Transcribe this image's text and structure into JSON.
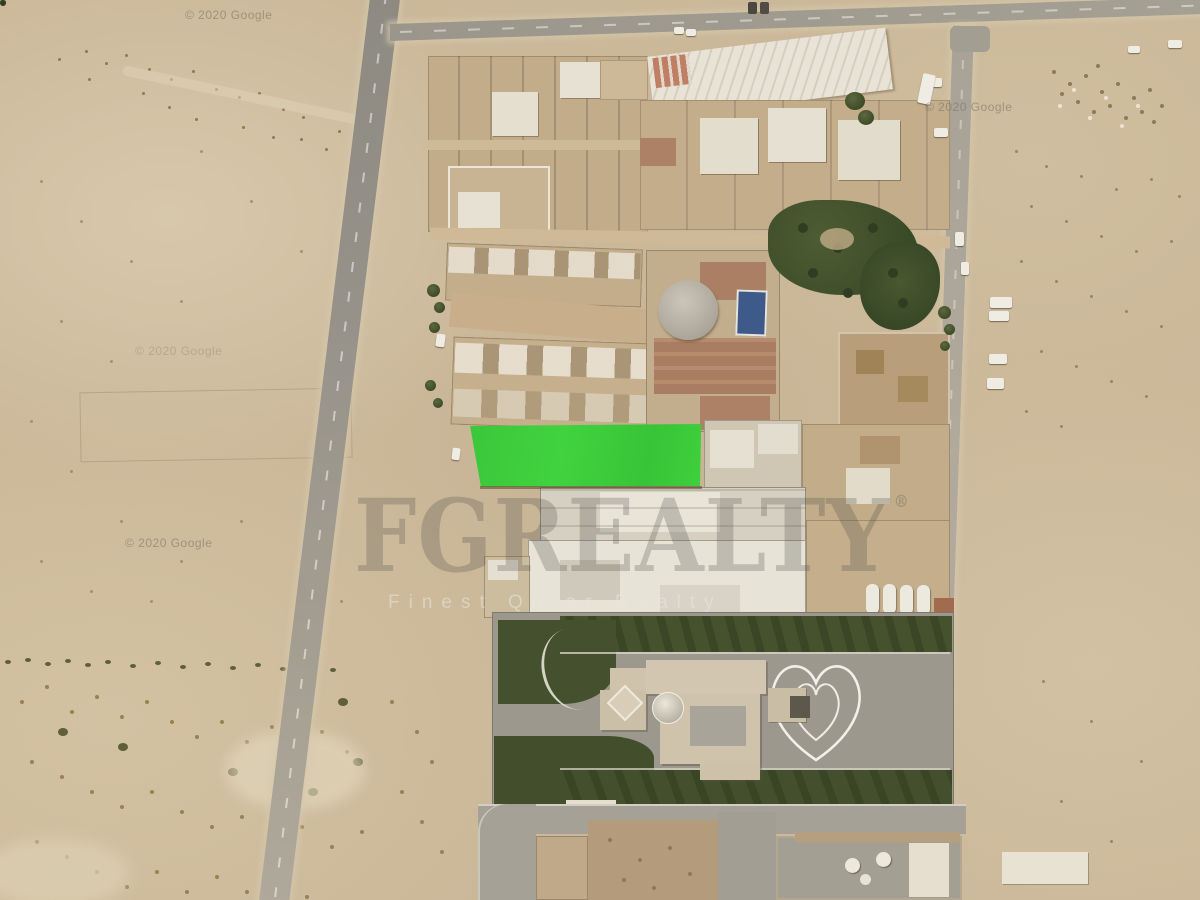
{
  "watermarks": {
    "google_copyright": "© 2020 Google",
    "brand_name": "FGREALTY",
    "brand_registered": "®",
    "brand_tagline": "Finest Qatar Realty"
  },
  "colors": {
    "highlight_green": "#3ecd3c",
    "desert_tan": "#cdbb9d",
    "road_gray": "#a29e93",
    "garden_green": "#46522e",
    "palm_green": "#47552f",
    "pool_blue": "#3d5a8b",
    "terracotta": "#ab7f63"
  }
}
